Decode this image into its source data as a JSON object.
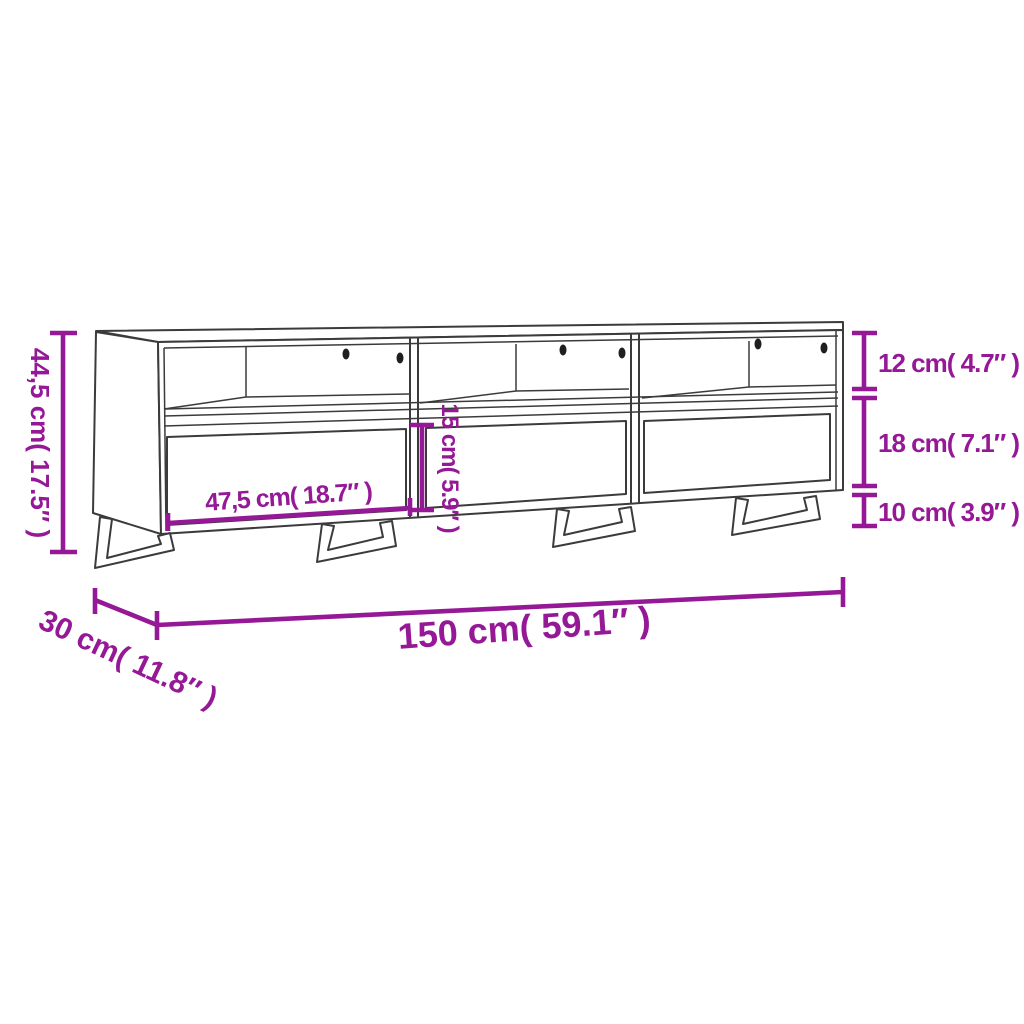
{
  "diagram": {
    "type": "product-dimension-diagram",
    "product": "TV cabinet with three open shelves, three drawers and metal sled legs",
    "colors": {
      "dimension": "#951896",
      "outline": "#3b3b3b",
      "hole": "#1f1f1f",
      "background": "#ffffff"
    },
    "labels": {
      "overall_height": "44,5 cm( 17.5″ )",
      "shelf_opening_height": "12 cm( 4.7″ )",
      "drawer_front_height": "18 cm( 7.1″ )",
      "leg_height": "10 cm( 3.9″ )",
      "drawer_opening_height": "15 cm( 5.9″ )",
      "drawer_width": "47,5 cm( 18.7″ )",
      "overall_width": "150 cm( 59.1″ )",
      "overall_depth": "30 cm( 11.8″ )"
    }
  }
}
